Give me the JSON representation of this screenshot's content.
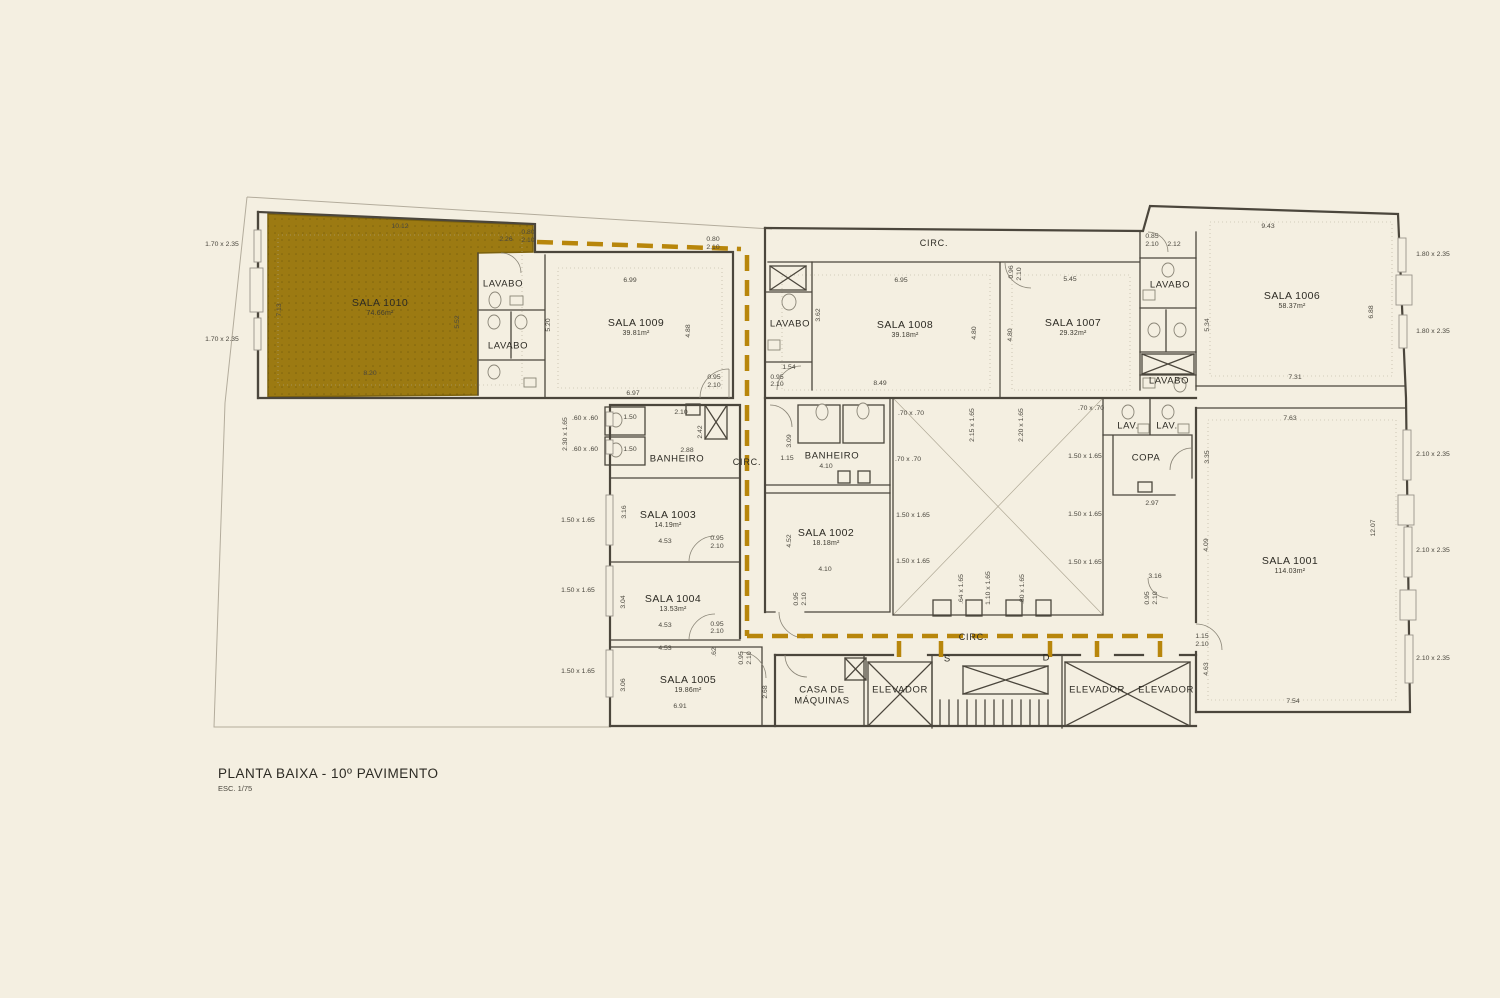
{
  "title": {
    "main": "PLANTA BAIXA - 10º PAVIMENTO",
    "scale": "ESC. 1/75"
  },
  "palette": {
    "background": "#f4efe1",
    "highlight": "#9c7a12",
    "circulation_path": "#b8860b",
    "wall": "#4b463c"
  },
  "selected_room": "SALA 1010",
  "rooms": [
    {
      "name": "SALA 1010",
      "area": "74.66m²",
      "x": 380,
      "y": 308,
      "highlighted": true
    },
    {
      "name": "SALA 1009",
      "area": "39.81m²",
      "x": 636,
      "y": 328
    },
    {
      "name": "SALA 1008",
      "area": "39.18m²",
      "x": 905,
      "y": 330
    },
    {
      "name": "SALA 1007",
      "area": "29.32m²",
      "x": 1073,
      "y": 328
    },
    {
      "name": "SALA 1006",
      "area": "58.37m²",
      "x": 1292,
      "y": 301
    },
    {
      "name": "SALA 1003",
      "area": "14.19m²",
      "x": 668,
      "y": 520
    },
    {
      "name": "SALA 1002",
      "area": "18.18m²",
      "x": 826,
      "y": 538
    },
    {
      "name": "SALA 1001",
      "area": "114.03m²",
      "x": 1290,
      "y": 566
    },
    {
      "name": "SALA 1004",
      "area": "13.53m²",
      "x": 673,
      "y": 604
    },
    {
      "name": "SALA 1005",
      "area": "19.86m²",
      "x": 688,
      "y": 685
    }
  ],
  "zones": [
    {
      "label": "LAVABO",
      "x": 503,
      "y": 285
    },
    {
      "label": "LAVABO",
      "x": 508,
      "y": 347
    },
    {
      "label": "LAVABO",
      "x": 790,
      "y": 325
    },
    {
      "label": "LAVABO",
      "x": 1170,
      "y": 286
    },
    {
      "label": "LAVABO",
      "x": 1169,
      "y": 382
    },
    {
      "label": "BANHEIRO",
      "x": 677,
      "y": 460
    },
    {
      "label": "BANHEIRO",
      "x": 832,
      "y": 457
    },
    {
      "label": "COPA",
      "x": 1146,
      "y": 459
    },
    {
      "label": "LAV.",
      "x": 1128,
      "y": 427
    },
    {
      "label": "LAV.",
      "x": 1167,
      "y": 427
    },
    {
      "label": "CASA DE\nMÁQUINAS",
      "x": 822,
      "y": 696
    },
    {
      "label": "ELEVADOR",
      "x": 900,
      "y": 691
    },
    {
      "label": "ELEVADOR",
      "x": 1097,
      "y": 691
    },
    {
      "label": "ELEVADOR",
      "x": 1166,
      "y": 691
    }
  ],
  "circulation": [
    {
      "label": "CIRC.",
      "x": 934,
      "y": 243
    },
    {
      "label": "CIRC.",
      "x": 747,
      "y": 462
    },
    {
      "label": "CIRC.",
      "x": 973,
      "y": 637
    }
  ],
  "markers": [
    {
      "label": "S",
      "x": 947,
      "y": 660
    },
    {
      "label": "D",
      "x": 1046,
      "y": 659
    }
  ],
  "dims": [
    {
      "t": "10.12",
      "x": 400,
      "y": 227
    },
    {
      "t": "2.26",
      "x": 506,
      "y": 240
    },
    {
      "t": "0.80",
      "x": 528,
      "y": 233
    },
    {
      "t": "2.10",
      "x": 528,
      "y": 241
    },
    {
      "t": "7.13",
      "x": 280,
      "y": 310,
      "v": true
    },
    {
      "t": "5.52",
      "x": 458,
      "y": 322,
      "v": true
    },
    {
      "t": "8.20",
      "x": 370,
      "y": 374
    },
    {
      "t": "1.70 x 2.35",
      "x": 222,
      "y": 245
    },
    {
      "t": "1.70 x 2.35",
      "x": 222,
      "y": 340
    },
    {
      "t": "0.80",
      "x": 713,
      "y": 240
    },
    {
      "t": "2.10",
      "x": 713,
      "y": 248
    },
    {
      "t": "6.99",
      "x": 630,
      "y": 281
    },
    {
      "t": "5.20",
      "x": 549,
      "y": 325,
      "v": true
    },
    {
      "t": "4.88",
      "x": 689,
      "y": 331,
      "v": true
    },
    {
      "t": "6.97",
      "x": 633,
      "y": 394
    },
    {
      "t": "0.95",
      "x": 714,
      "y": 378
    },
    {
      "t": "2.10",
      "x": 714,
      "y": 386
    },
    {
      "t": "1.54",
      "x": 789,
      "y": 368
    },
    {
      "t": "0.95",
      "x": 777,
      "y": 378
    },
    {
      "t": "2.10",
      "x": 777,
      "y": 385
    },
    {
      "t": "3.62",
      "x": 819,
      "y": 315,
      "v": true
    },
    {
      "t": "6.95",
      "x": 901,
      "y": 281
    },
    {
      "t": "4.80",
      "x": 975,
      "y": 333,
      "v": true
    },
    {
      "t": "4.80",
      "x": 1011,
      "y": 335,
      "v": true
    },
    {
      "t": "8.49",
      "x": 880,
      "y": 384
    },
    {
      "t": "0.96",
      "x": 1012,
      "y": 272,
      "v": true
    },
    {
      "t": "2.10",
      "x": 1020,
      "y": 274,
      "v": true
    },
    {
      "t": "5.45",
      "x": 1070,
      "y": 280
    },
    {
      "t": "0.85",
      "x": 1152,
      "y": 237
    },
    {
      "t": "2.10",
      "x": 1152,
      "y": 245
    },
    {
      "t": "2.12",
      "x": 1174,
      "y": 245
    },
    {
      "t": "5.34",
      "x": 1208,
      "y": 325,
      "v": true
    },
    {
      "t": "9.43",
      "x": 1268,
      "y": 227
    },
    {
      "t": "6.88",
      "x": 1372,
      "y": 312,
      "v": true
    },
    {
      "t": "7.31",
      "x": 1295,
      "y": 378
    },
    {
      "t": "1.80 x 2.35",
      "x": 1433,
      "y": 255
    },
    {
      "t": "1.80 x 2.35",
      "x": 1433,
      "y": 332
    },
    {
      "t": "2.10 x 2.35",
      "x": 1433,
      "y": 455
    },
    {
      "t": "2.10 x 2.35",
      "x": 1433,
      "y": 551
    },
    {
      "t": "2.10 x 2.35",
      "x": 1433,
      "y": 659
    },
    {
      "t": ".60 x .60",
      "x": 585,
      "y": 419
    },
    {
      "t": ".60 x .60",
      "x": 585,
      "y": 450
    },
    {
      "t": "2.30 x 1.65",
      "x": 566,
      "y": 434,
      "v": true
    },
    {
      "t": "1.50",
      "x": 630,
      "y": 418
    },
    {
      "t": "1.50",
      "x": 630,
      "y": 450
    },
    {
      "t": "2.10",
      "x": 681,
      "y": 413
    },
    {
      "t": "2.42",
      "x": 701,
      "y": 432,
      "v": true
    },
    {
      "t": "2.88",
      "x": 687,
      "y": 451
    },
    {
      "t": "3.16",
      "x": 625,
      "y": 512,
      "v": true
    },
    {
      "t": "4.53",
      "x": 665,
      "y": 542
    },
    {
      "t": "0.95",
      "x": 717,
      "y": 539
    },
    {
      "t": "2.10",
      "x": 717,
      "y": 547
    },
    {
      "t": "1.50 x 1.65",
      "x": 578,
      "y": 521
    },
    {
      "t": "1.50 x 1.65",
      "x": 578,
      "y": 591
    },
    {
      "t": "1.50 x 1.65",
      "x": 578,
      "y": 672
    },
    {
      "t": "3.04",
      "x": 624,
      "y": 602,
      "v": true
    },
    {
      "t": "4.53",
      "x": 665,
      "y": 626
    },
    {
      "t": "0.95",
      "x": 717,
      "y": 625
    },
    {
      "t": "2.10",
      "x": 717,
      "y": 632
    },
    {
      "t": "4.53",
      "x": 665,
      "y": 649
    },
    {
      "t": ".62",
      "x": 715,
      "y": 652,
      "v": true
    },
    {
      "t": "0.95",
      "x": 742,
      "y": 658,
      "v": true
    },
    {
      "t": "2.10",
      "x": 750,
      "y": 658,
      "v": true
    },
    {
      "t": "3.06",
      "x": 624,
      "y": 685,
      "v": true
    },
    {
      "t": "6.91",
      "x": 680,
      "y": 707
    },
    {
      "t": "2.68",
      "x": 766,
      "y": 692,
      "v": true
    },
    {
      "t": "3.09",
      "x": 790,
      "y": 441,
      "v": true
    },
    {
      "t": "1.15",
      "x": 787,
      "y": 459
    },
    {
      "t": "4.10",
      "x": 826,
      "y": 467
    },
    {
      "t": "4.52",
      "x": 790,
      "y": 541,
      "v": true
    },
    {
      "t": "4.10",
      "x": 825,
      "y": 570
    },
    {
      "t": "0.95",
      "x": 797,
      "y": 599,
      "v": true
    },
    {
      "t": "2.10",
      "x": 805,
      "y": 599,
      "v": true
    },
    {
      "t": ".70 x .70",
      "x": 911,
      "y": 414
    },
    {
      "t": ".70 x .70",
      "x": 908,
      "y": 460
    },
    {
      "t": "2.15 x 1.65",
      "x": 973,
      "y": 425,
      "v": true
    },
    {
      "t": "2.20 x 1.65",
      "x": 1022,
      "y": 425,
      "v": true
    },
    {
      "t": "1.50 x 1.65",
      "x": 913,
      "y": 516
    },
    {
      "t": "1.50 x 1.65",
      "x": 913,
      "y": 562
    },
    {
      "t": ".64 x 1.65",
      "x": 962,
      "y": 589,
      "v": true
    },
    {
      "t": "1.10 x 1.65",
      "x": 989,
      "y": 588,
      "v": true
    },
    {
      "t": ".80 x 1.65",
      "x": 1023,
      "y": 589,
      "v": true
    },
    {
      "t": ".70 x .70",
      "x": 1091,
      "y": 409
    },
    {
      "t": "1.50 x 1.65",
      "x": 1085,
      "y": 457
    },
    {
      "t": "1.50 x 1.65",
      "x": 1085,
      "y": 515
    },
    {
      "t": "1.50 x 1.65",
      "x": 1085,
      "y": 563
    },
    {
      "t": "3.35",
      "x": 1208,
      "y": 457,
      "v": true
    },
    {
      "t": "2.97",
      "x": 1152,
      "y": 504
    },
    {
      "t": "4.09",
      "x": 1207,
      "y": 545,
      "v": true
    },
    {
      "t": "3.16",
      "x": 1155,
      "y": 577
    },
    {
      "t": "0.95",
      "x": 1148,
      "y": 598,
      "v": true
    },
    {
      "t": "2.10",
      "x": 1156,
      "y": 598,
      "v": true
    },
    {
      "t": "7.63",
      "x": 1290,
      "y": 419
    },
    {
      "t": "12.07",
      "x": 1374,
      "y": 528,
      "v": true
    },
    {
      "t": "1.15",
      "x": 1202,
      "y": 637
    },
    {
      "t": "2.10",
      "x": 1202,
      "y": 645
    },
    {
      "t": "4.63",
      "x": 1207,
      "y": 669,
      "v": true
    },
    {
      "t": "7.54",
      "x": 1293,
      "y": 702
    }
  ]
}
